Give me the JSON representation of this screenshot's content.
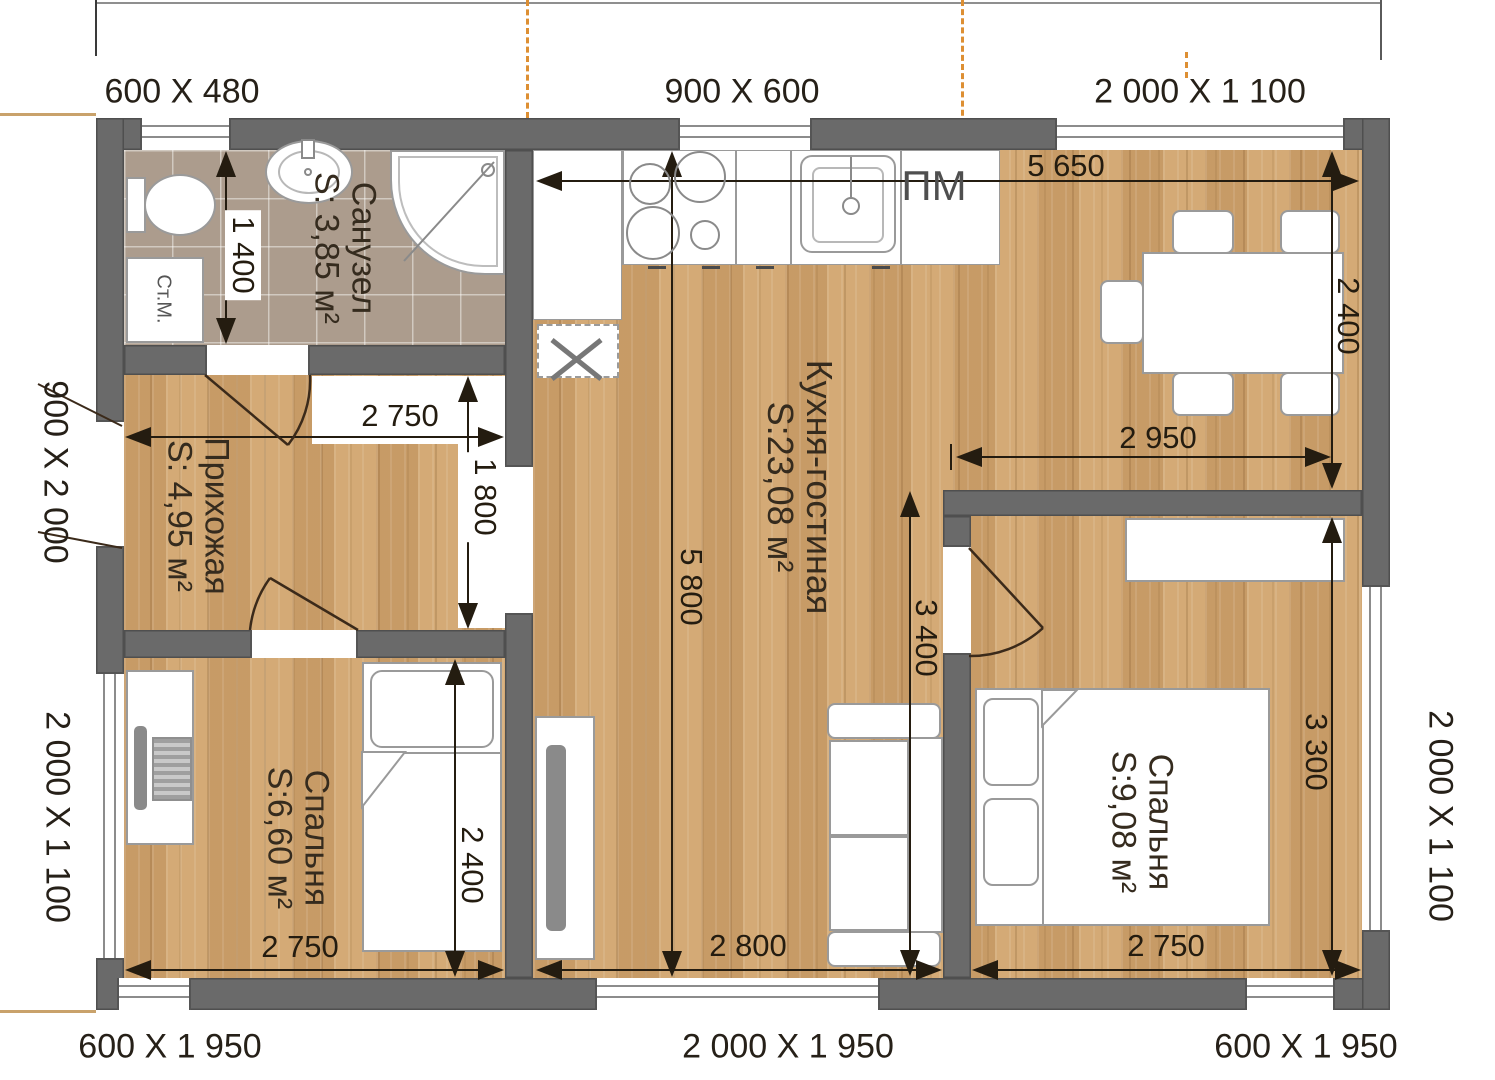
{
  "windows": {
    "top_bath": "600 X 480",
    "top_kitchen": "900 X 600",
    "top_dining": "2 000 X 1 100",
    "left_entry": "900 X 2 000",
    "left_bedroom": "2 000 X 1 100",
    "right_bedroom": "2 000 X 1 100",
    "bottom_left": "600 X 1 950",
    "bottom_center": "2 000 X 1 950",
    "bottom_right": "600 X 1 950"
  },
  "rooms": {
    "bathroom": {
      "name": "Санузел",
      "area": "S: 3,85 м²"
    },
    "hallway": {
      "name": "Прихожая",
      "area": "S: 4,95 м²"
    },
    "bedroom1": {
      "name": "Спальня",
      "area": "S:6,60 м²"
    },
    "kitchen": {
      "name": "Кухня-гостиная",
      "area": "S:23,08 м²"
    },
    "bedroom2": {
      "name": "Спальня",
      "area": "S:9,08 м²"
    }
  },
  "dims": {
    "bath_height": "1 400",
    "hall_width": "2 750",
    "hall_height": "1 800",
    "bedroom1_width": "2 750",
    "bedroom1_height": "2 400",
    "kitchen_width": "5 650",
    "kitchen_height": "5 800",
    "dining_height": "2 400",
    "mid_width": "2 950",
    "kitchen_lower_height": "3 400",
    "living_width": "2 800",
    "bedroom2_height": "3 300",
    "bedroom2_width": "2 750"
  },
  "labels": {
    "washing_machine": "Ст.М.",
    "dishwasher": "ПМ"
  },
  "colors": {
    "wall": "#6a6a6a",
    "wood_floor": "#cfa470",
    "tile_floor": "#ac9c8d",
    "dimension": "#241c10",
    "axis": "#dd8f33"
  }
}
